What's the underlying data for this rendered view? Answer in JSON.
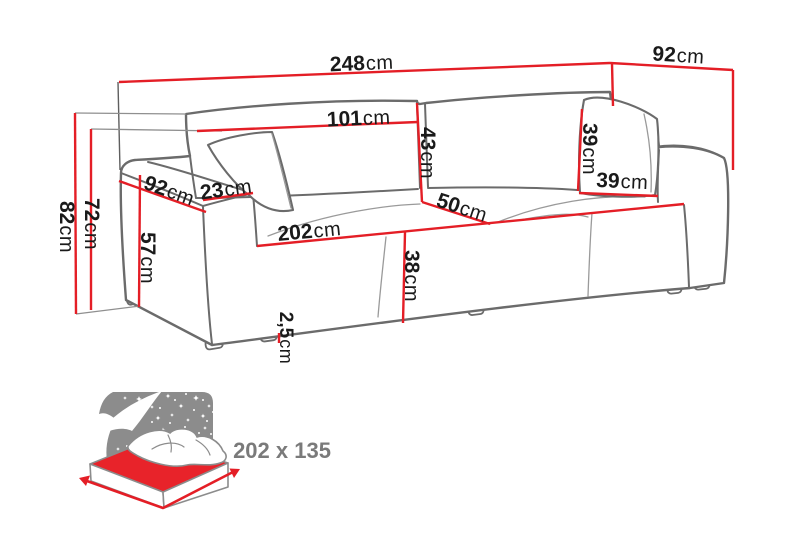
{
  "title": "Sofa bed dimension diagram",
  "dims": {
    "width_total": {
      "value": "248",
      "unit": "cm"
    },
    "depth_total": {
      "value": "92",
      "unit": "cm"
    },
    "back_cushion_width": {
      "value": "101",
      "unit": "cm"
    },
    "back_cushion_height": {
      "value": "43",
      "unit": "cm"
    },
    "pillow_height": {
      "value": "39",
      "unit": "cm"
    },
    "pillow_width": {
      "value": "39",
      "unit": "cm"
    },
    "arm_depth": {
      "value": "92",
      "unit": "cm"
    },
    "arm_width": {
      "value": "23",
      "unit": "cm"
    },
    "arm_height": {
      "value": "57",
      "unit": "cm"
    },
    "height_total": {
      "value": "82",
      "unit": "cm"
    },
    "height_back": {
      "value": "72",
      "unit": "cm"
    },
    "seat_width": {
      "value": "202",
      "unit": "cm"
    },
    "seat_depth": {
      "value": "50",
      "unit": "cm"
    },
    "seat_height": {
      "value": "38",
      "unit": "cm"
    },
    "leg_height": {
      "value": "2,5",
      "unit": "cm"
    }
  },
  "sleeping_area": {
    "icon": "sleeping-function-bed-icon",
    "size_label": "202 x 135"
  },
  "colors": {
    "dimension_red": "#e41e26",
    "outline_gray": "#6b6b6b",
    "seam_gray": "#9a9a9a",
    "label_black": "#1a1a1a",
    "icon_gray": "#8c8c8c",
    "mattress_red": "#e8232a",
    "icon_text_gray": "#7a7a7a",
    "background": "#ffffff"
  }
}
